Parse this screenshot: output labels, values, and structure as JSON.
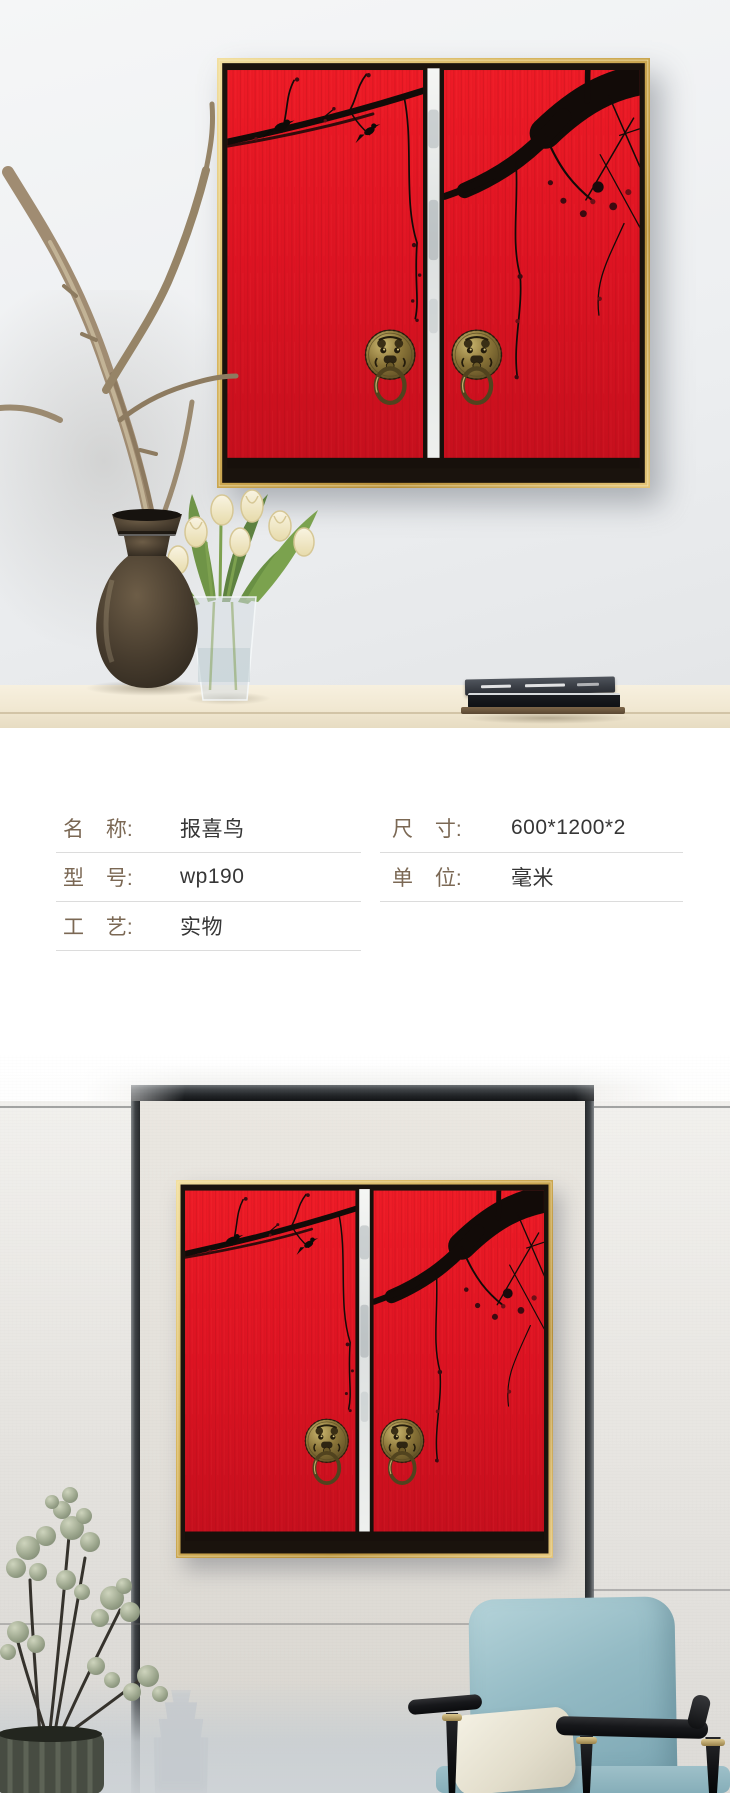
{
  "info": {
    "left_rows": [
      {
        "label": "名 称:",
        "value": "报喜鸟"
      },
      {
        "label": "型 号:",
        "value": "wp190"
      },
      {
        "label": "工 艺:",
        "value": "实物"
      }
    ],
    "right_rows": [
      {
        "label": "尺 寸:",
        "value": "600*1200*2"
      },
      {
        "label": "单 位:",
        "value": "毫米"
      }
    ]
  },
  "colors": {
    "artwork_red": "#dd1322",
    "frame_gold": "#d8b660",
    "label_brown": "#7b6854",
    "value_dark": "#363636",
    "divider": "#dcdcdc",
    "chair_teal": "#8fb6c0",
    "wall_gray": "#e8e6e2",
    "table_cream": "#f3ebd8"
  }
}
